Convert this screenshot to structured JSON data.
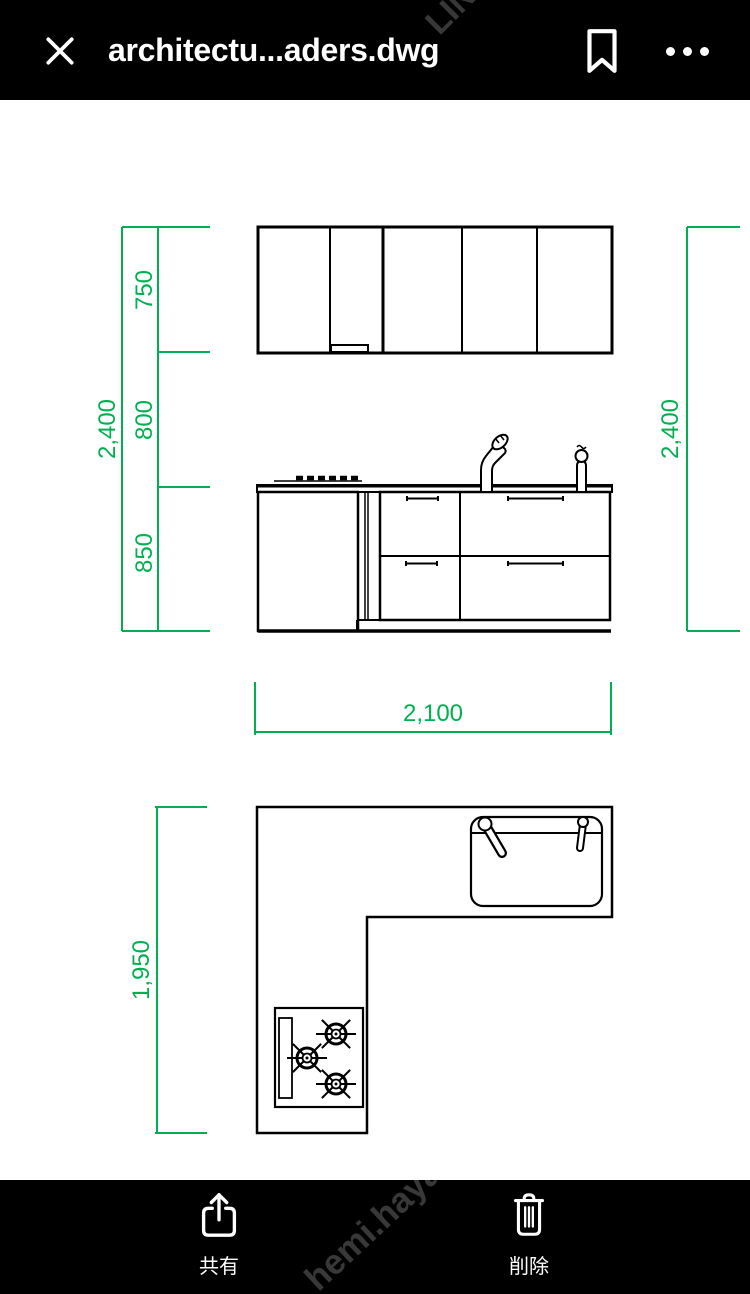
{
  "header": {
    "title": "architectu...aders.dwg"
  },
  "viewer": {
    "dimension_color": "#00B050",
    "line_color": "#000000",
    "dimensions": {
      "left_total": "2,400",
      "seg_top": "750",
      "seg_mid": "800",
      "seg_bottom": "850",
      "right_total": "2,400",
      "elevation_width": "2,100",
      "plan_depth": "1,950"
    }
  },
  "footer": {
    "share_label": "共有",
    "delete_label": "削除"
  },
  "watermark": {
    "top": "LIN",
    "bottom": "hemi.haya"
  }
}
